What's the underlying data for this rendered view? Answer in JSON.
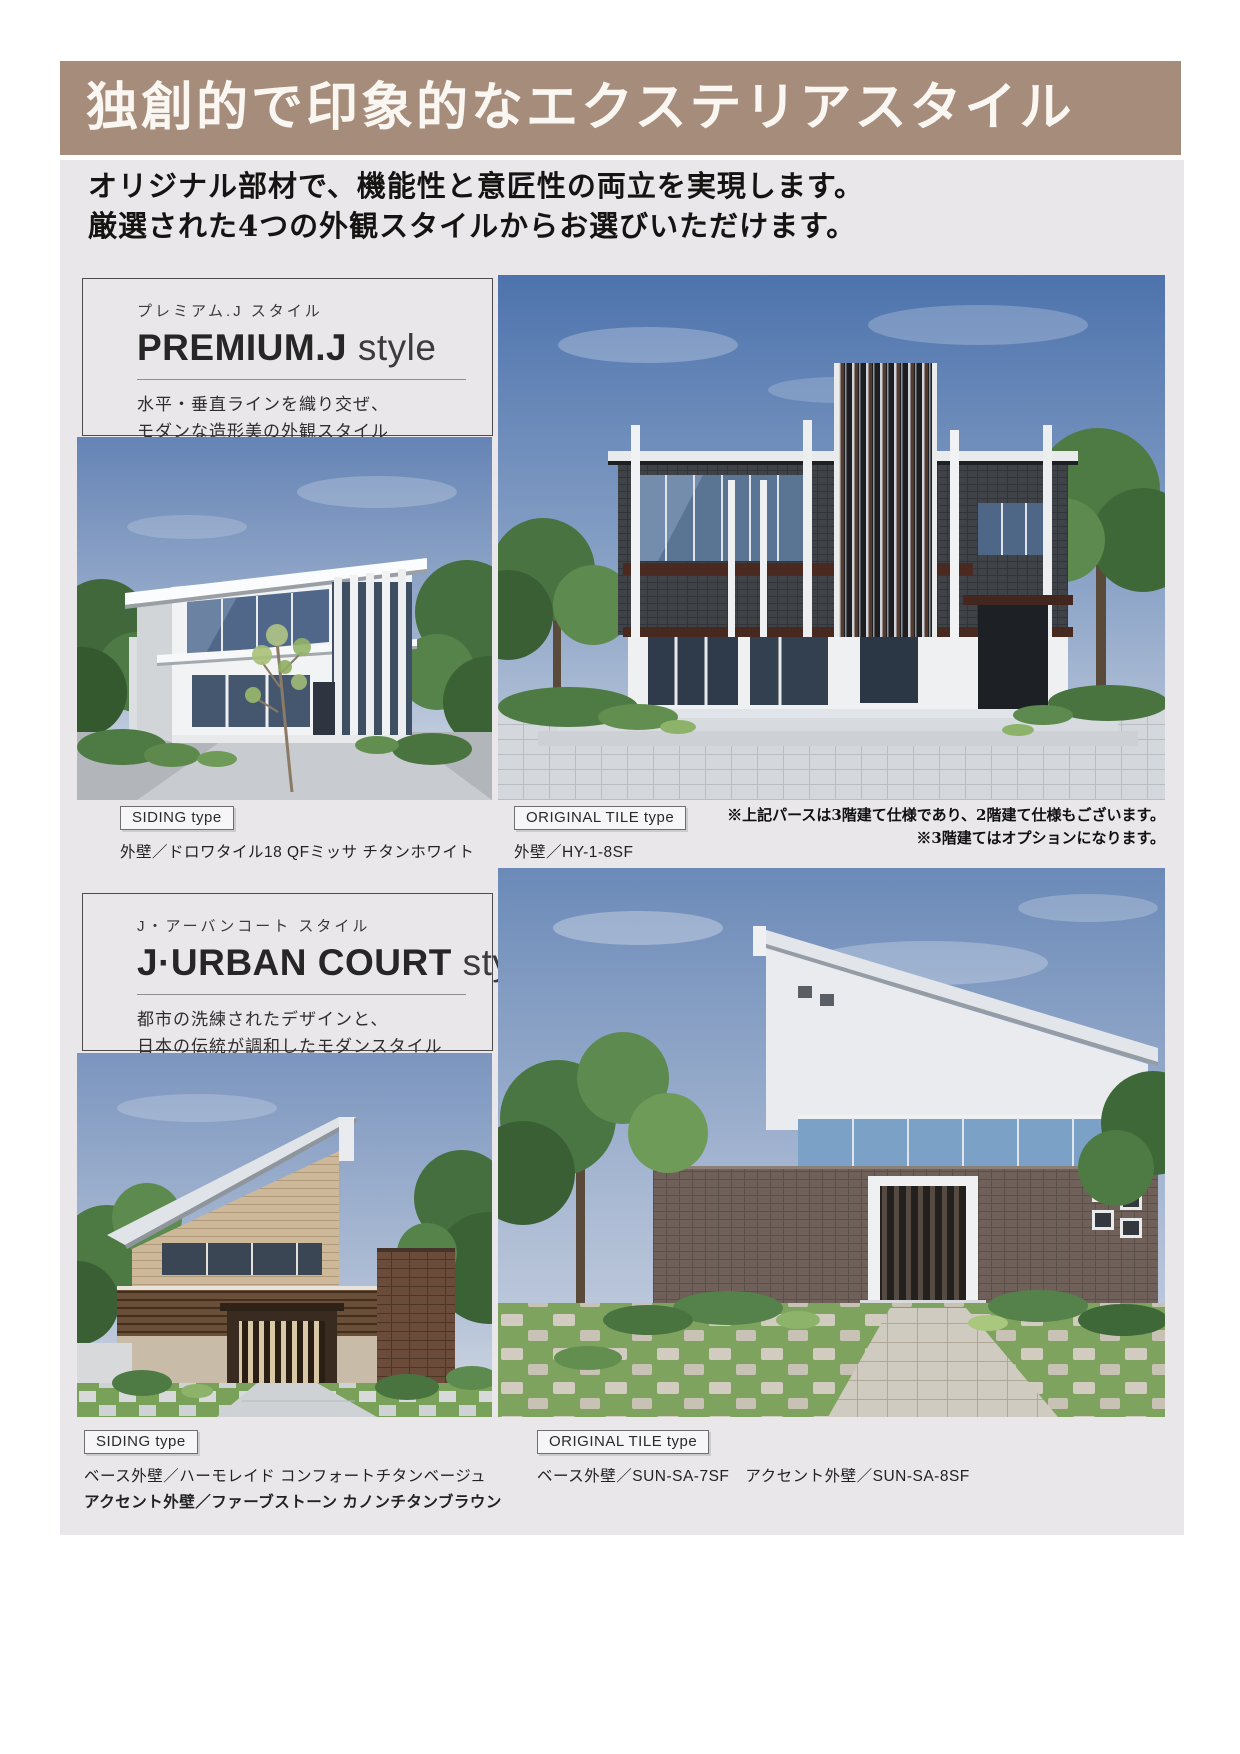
{
  "banner": {
    "title": "独創的で印象的なエクステリアスタイル"
  },
  "intro": {
    "line1": "オリジナル部材で、機能性と意匠性の両立を実現します。",
    "line2": "厳選された4つの外観スタイルからお選びいただけます。"
  },
  "sections": [
    {
      "kana": "プレミアム.J スタイル",
      "name": "PREMIUM.J",
      "name_suffix": "style",
      "desc1": "水平・垂直ラインを織り交ぜ、",
      "desc2": "モダンな造形美の外観スタイル",
      "siding_badge": "SIDING type",
      "siding_caption": "外壁／ドロワタイル18 QFミッサ チタンホワイト",
      "tile_badge": "ORIGINAL TILE type",
      "tile_caption": "外壁／HY-1-8SF",
      "note1": "※上記パースは3階建て仕様であり、2階建て仕様もございます。",
      "note2": "※3階建てはオプションになります。"
    },
    {
      "kana": "J・アーバンコート スタイル",
      "name": "J·URBAN COURT",
      "name_suffix": "style",
      "desc1": "都市の洗練されたデザインと、",
      "desc2": "日本の伝統が調和したモダンスタイル",
      "siding_badge": "SIDING type",
      "siding_caption": "ベース外壁／ハーモレイド コンフォートチタンベージュ",
      "siding_caption2": "アクセント外壁／ファーブストーン カノンチタンブラウン",
      "tile_badge": "ORIGINAL TILE type",
      "tile_caption": "ベース外壁／SUN-SA-7SF　アクセント外壁／SUN-SA-8SF"
    }
  ],
  "colors": {
    "banner_bg": "#a68c7a",
    "page_bg": "#e9e7ea",
    "text": "#1c1c1c"
  }
}
